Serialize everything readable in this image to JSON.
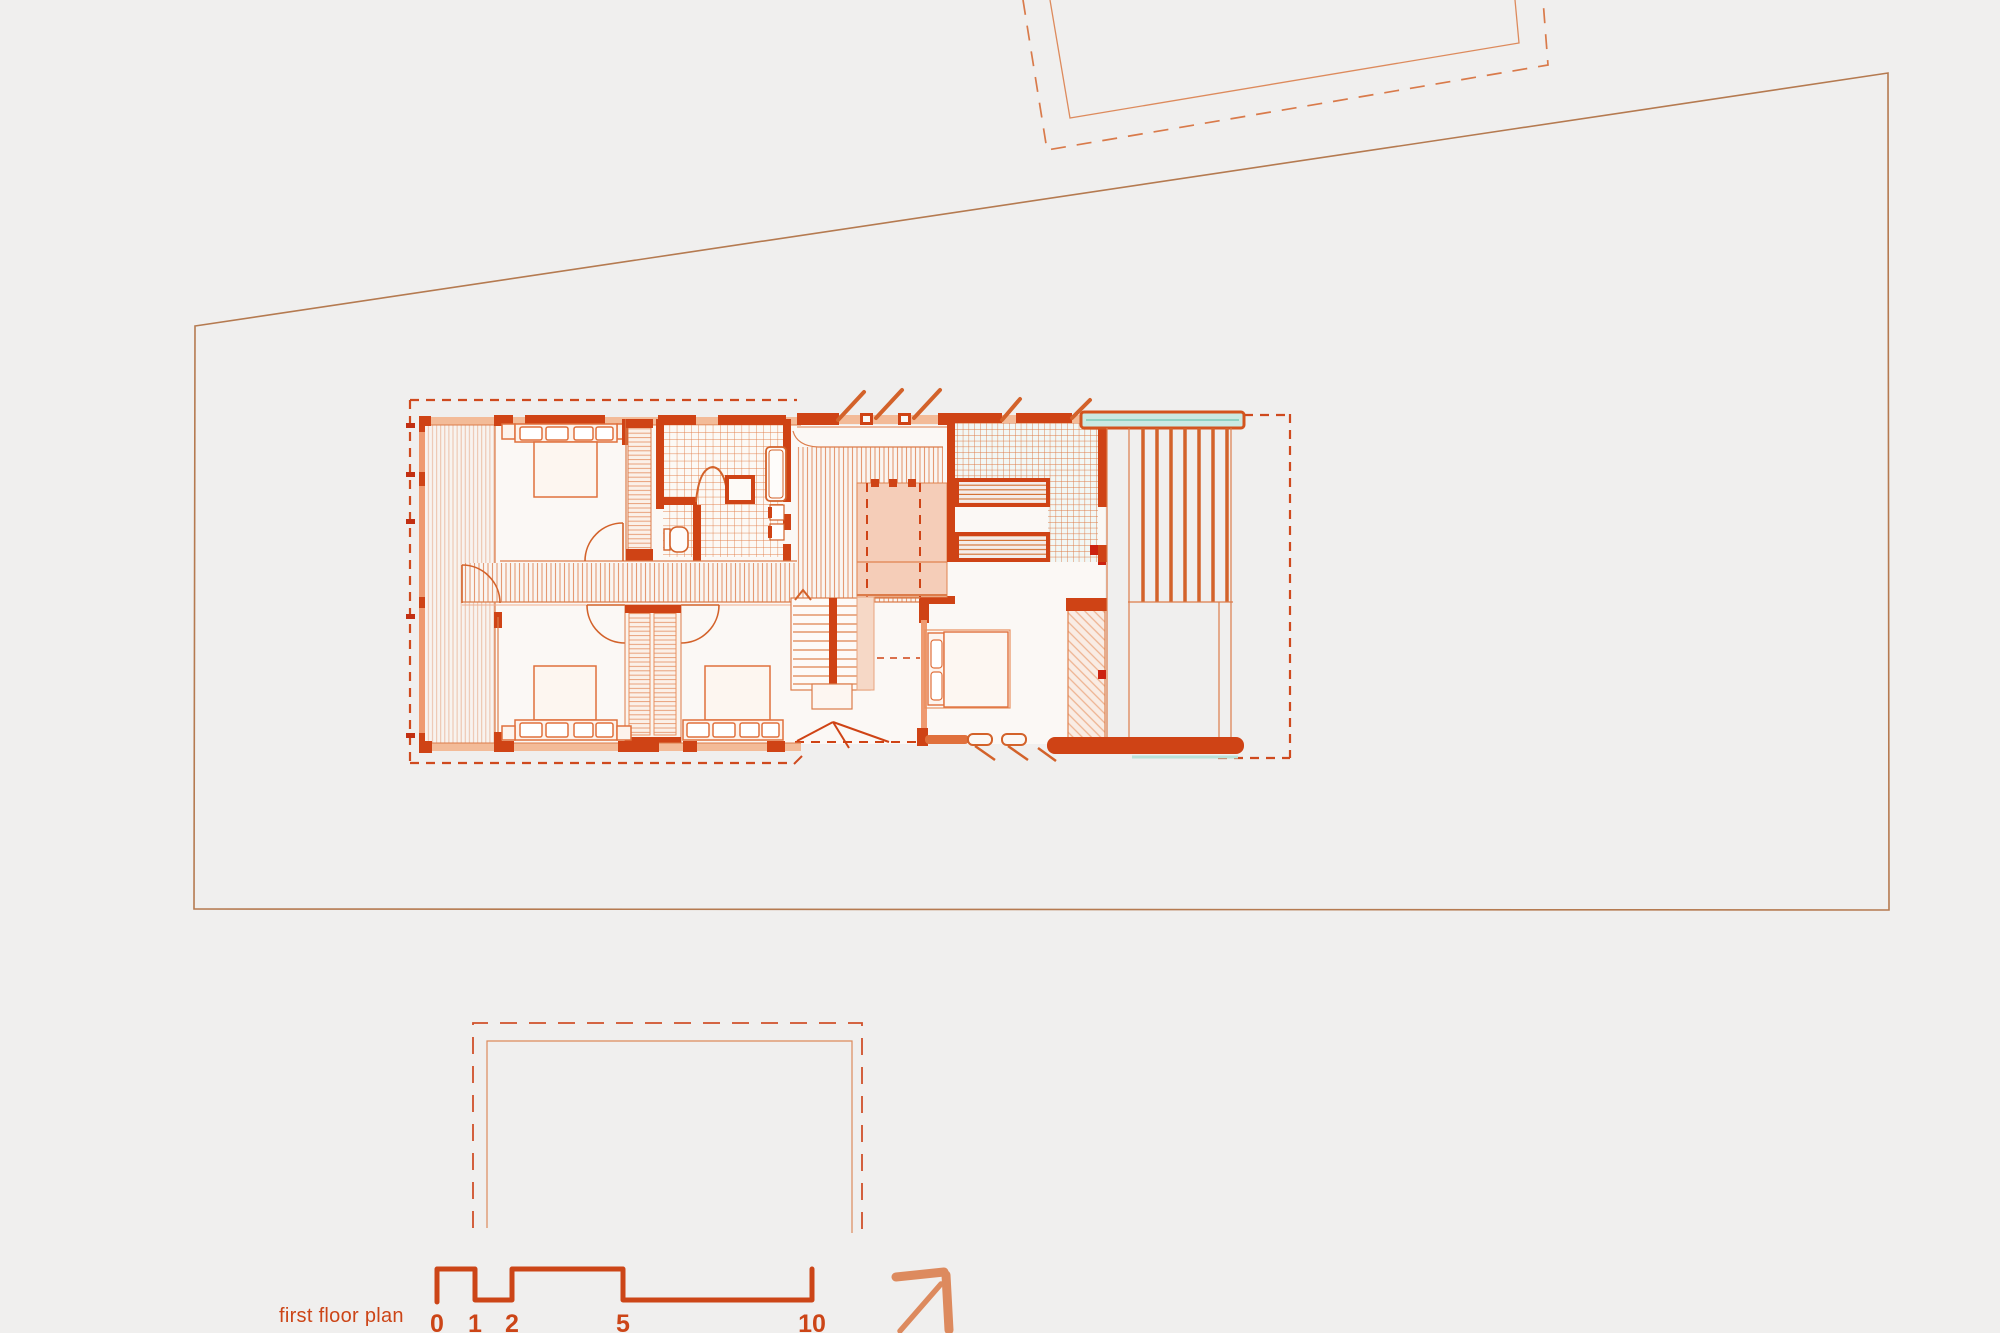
{
  "drawing": {
    "label": "first floor plan"
  },
  "scale_bar": {
    "labels": [
      "0",
      "1",
      "2",
      "5",
      "10"
    ]
  },
  "icons": {
    "north_arrow": "↗"
  },
  "colors": {
    "background": "#f0efee",
    "ink": "#cc4517",
    "wall_dark": "#cf4315",
    "wall_medium": "#e0703c",
    "wall_light": "#f3bb98",
    "thin_line": "#dc7c4a",
    "hatch": "#e59a74",
    "site_line": "#b57a50",
    "dash_line": "#cf4a1e",
    "teal_accent": "#c9e9e1",
    "pink_fill": "#f5cdb8",
    "north_arrow": "#dd8a5e"
  }
}
